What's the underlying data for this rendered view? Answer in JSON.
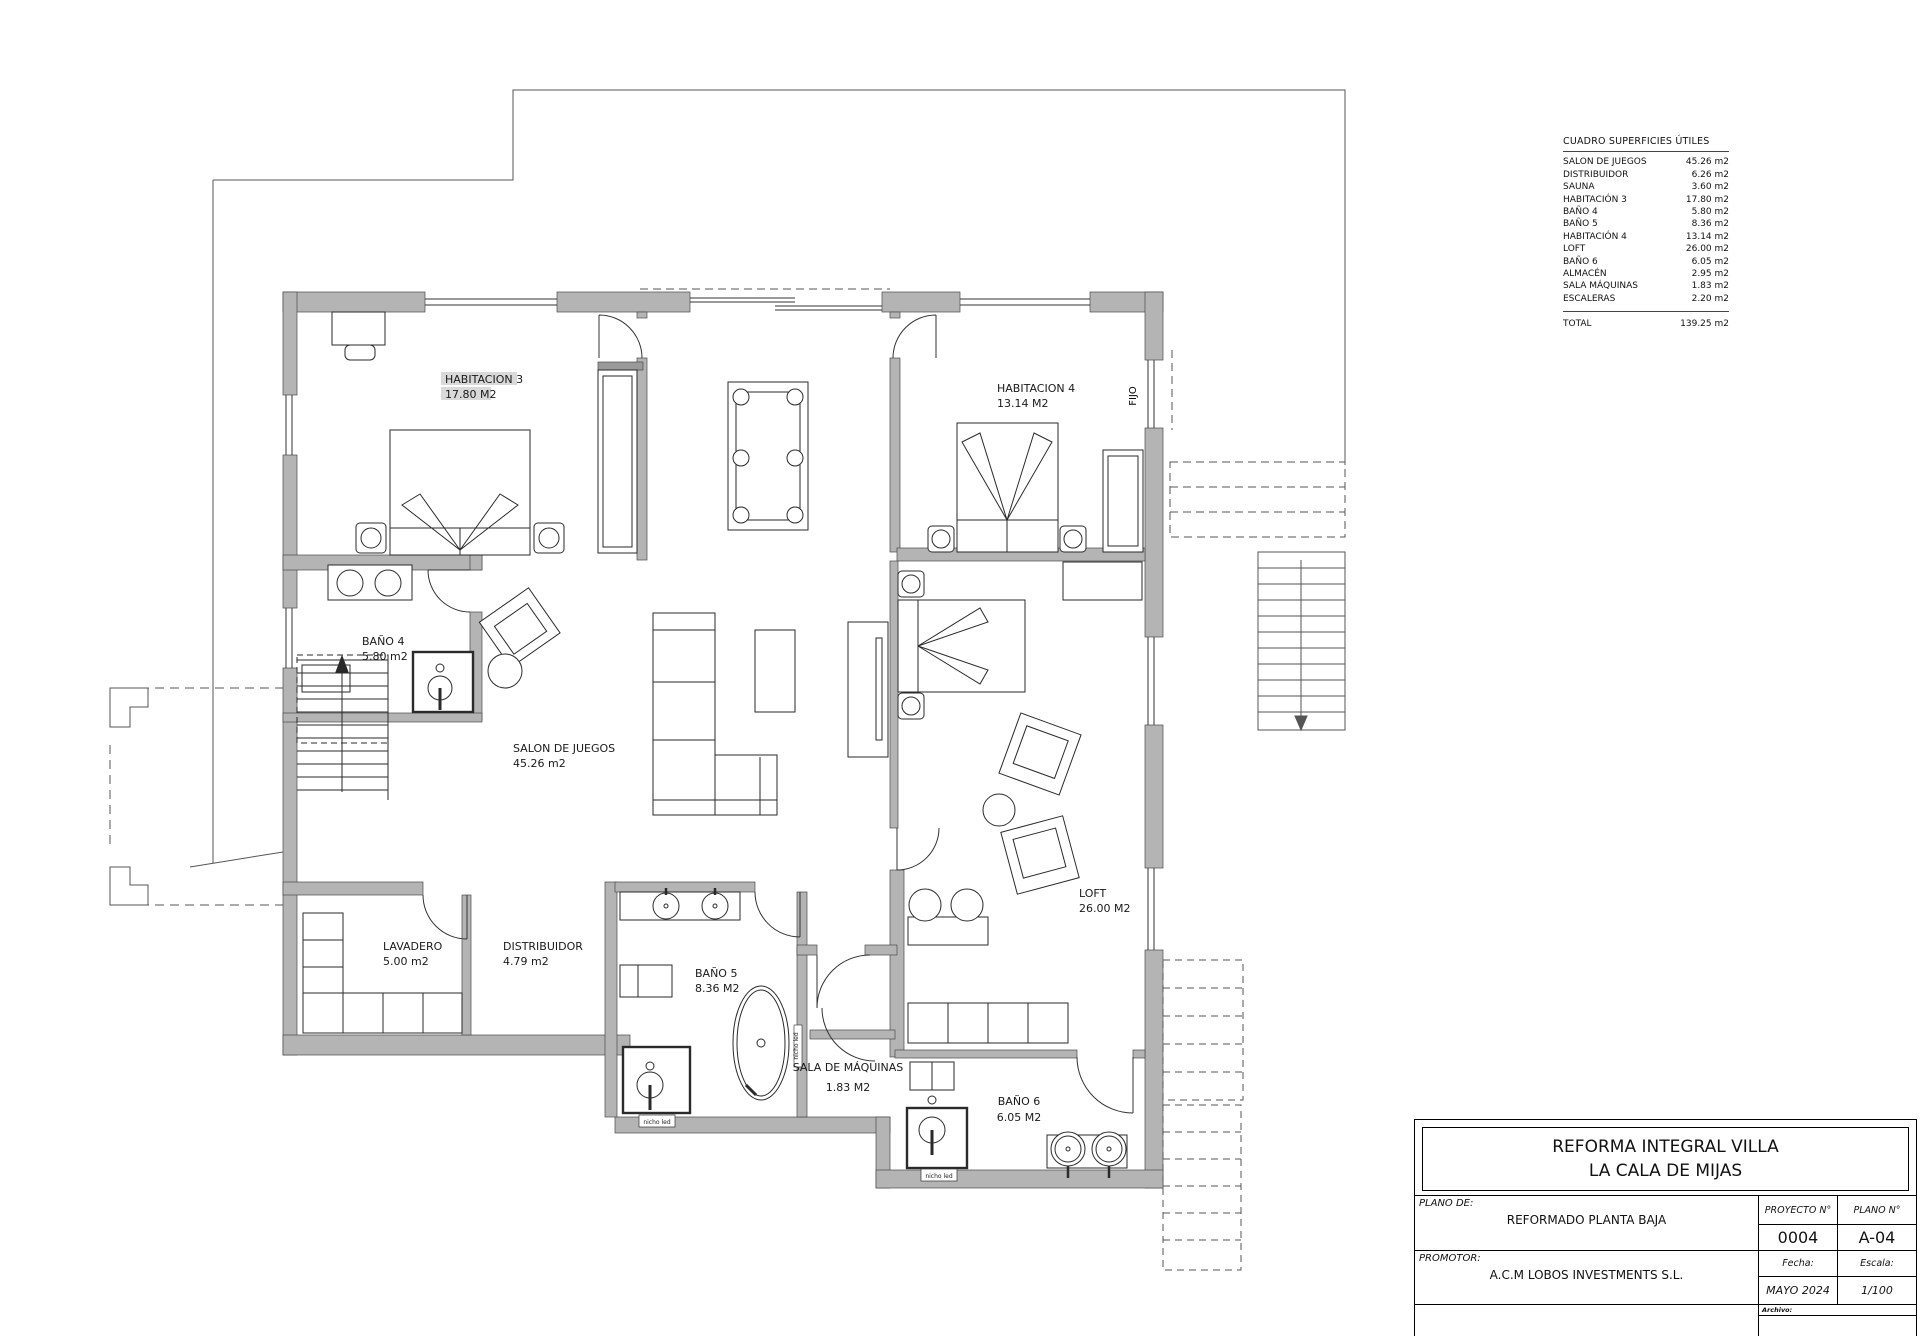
{
  "colors": {
    "wall": "#b4b4b4",
    "wall_dark": "#9a9a9a",
    "highlight": "#d9d9d9",
    "line": "#333333"
  },
  "plan": {
    "rooms": [
      {
        "label": "HABITACION 3",
        "area": "17.80 M2"
      },
      {
        "label": "HABITACION 4",
        "area": "13.14 M2"
      },
      {
        "label": "BAÑO 4",
        "area": "5.80 m2"
      },
      {
        "label": "SALON DE JUEGOS",
        "area": "45.26 m2"
      },
      {
        "label": "LAVADERO",
        "area": "5.00 m2"
      },
      {
        "label": "DISTRIBUIDOR",
        "area": "4.79 m2"
      },
      {
        "label": "BAÑO 5",
        "area": "8.36 M2"
      },
      {
        "label": "SALA DE MÁQUINAS",
        "area": "1.83 M2"
      },
      {
        "label": "BAÑO 6",
        "area": "6.05 M2"
      },
      {
        "label": "LOFT",
        "area": "26.00 M2"
      }
    ],
    "annotations": {
      "fijo": "FIJO",
      "nicho_led": "nicho led"
    }
  },
  "surface_table": {
    "title": "CUADRO SUPERFICIES ÚTILES",
    "rows": [
      {
        "name": "SALON DE JUEGOS",
        "value": "45.26 m2"
      },
      {
        "name": "DISTRIBUIDOR",
        "value": "6.26 m2"
      },
      {
        "name": "SAUNA",
        "value": "3.60 m2"
      },
      {
        "name": "HABITACIÓN 3",
        "value": "17.80 m2"
      },
      {
        "name": "BAÑO 4",
        "value": "5.80 m2"
      },
      {
        "name": "BAÑO 5",
        "value": "8.36 m2"
      },
      {
        "name": "HABITACIÓN 4",
        "value": "13.14 m2"
      },
      {
        "name": "LOFT",
        "value": "26.00 m2"
      },
      {
        "name": "BAÑO 6",
        "value": "6.05 m2"
      },
      {
        "name": "ALMACÉN",
        "value": "2.95 m2"
      },
      {
        "name": "SALA MÁQUINAS",
        "value": "1.83 m2"
      },
      {
        "name": "ESCALERAS",
        "value": "2.20 m2"
      }
    ],
    "total_label": "TOTAL",
    "total_value": "139.25 m2"
  },
  "title_block": {
    "project_title_line1": "REFORMA INTEGRAL VILLA",
    "project_title_line2": "LA CALA DE MIJAS",
    "plano_de_label": "PLANO  DE:",
    "plano_de_value": "REFORMADO PLANTA BAJA",
    "promotor_label": "PROMOTOR:",
    "promotor_value": "A.C.M LOBOS INVESTMENTS S.L.",
    "proyecto_label": "PROYECTO  N°",
    "proyecto_value": "0004",
    "plano_num_label": "PLANO  N°",
    "plano_num_value": "A-04",
    "fecha_label": "Fecha:",
    "fecha_value": "MAYO  2024",
    "escala_label": "Escala:",
    "escala_value": "1/100",
    "archivo_label": "Archivo:"
  }
}
